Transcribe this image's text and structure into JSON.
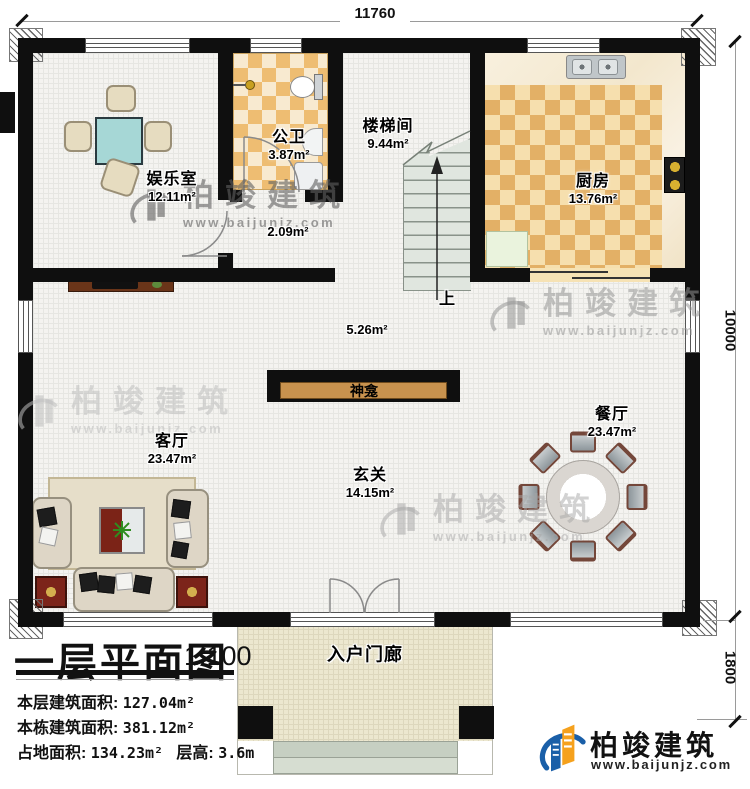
{
  "dims": {
    "top": "11760",
    "right": "10000",
    "porch": "1800"
  },
  "rooms": {
    "entertainment": {
      "name": "娱乐室",
      "area": "12.11m²"
    },
    "bathroom": {
      "name": "公卫",
      "area": "3.87m²"
    },
    "stair": {
      "name": "楼梯间",
      "area": "9.44m²"
    },
    "kitchen": {
      "name": "厨房",
      "area": "13.76m²"
    },
    "hall": {
      "area": "2.09m²"
    },
    "landing": {
      "area": "5.26m²"
    },
    "foyer": {
      "name": "玄关",
      "area": "14.15m²"
    },
    "living": {
      "name": "客厅",
      "area": "23.47m²"
    },
    "dining": {
      "name": "餐厅",
      "area": "23.47m²"
    },
    "porch": {
      "name": "入户门廊"
    }
  },
  "annotations": {
    "shrine": "神龛",
    "up": "上"
  },
  "titleblock": {
    "title": "一层平面图",
    "scale": "1:100",
    "row1_label": "本层建筑面积:",
    "row1_value": "127.04m²",
    "row2_label": "本栋建筑面积:",
    "row2_value": "381.12m²",
    "row3a_label": "占地面积:",
    "row3a_value": "134.23m²",
    "row3b_label": "层高:",
    "row3b_value": "3.6m"
  },
  "brand": {
    "name": "柏竣建筑",
    "site": "www.baijunjz.com"
  },
  "watermark": {
    "name": "柏竣建筑",
    "site": "www.baijunjz.com"
  },
  "colors": {
    "wall": "#0f0f0f",
    "tile_dark": "#eebd72",
    "tile_light": "#f8ead0",
    "brand_blue": "#1a5fa8",
    "brand_orange": "#f5a11d"
  }
}
